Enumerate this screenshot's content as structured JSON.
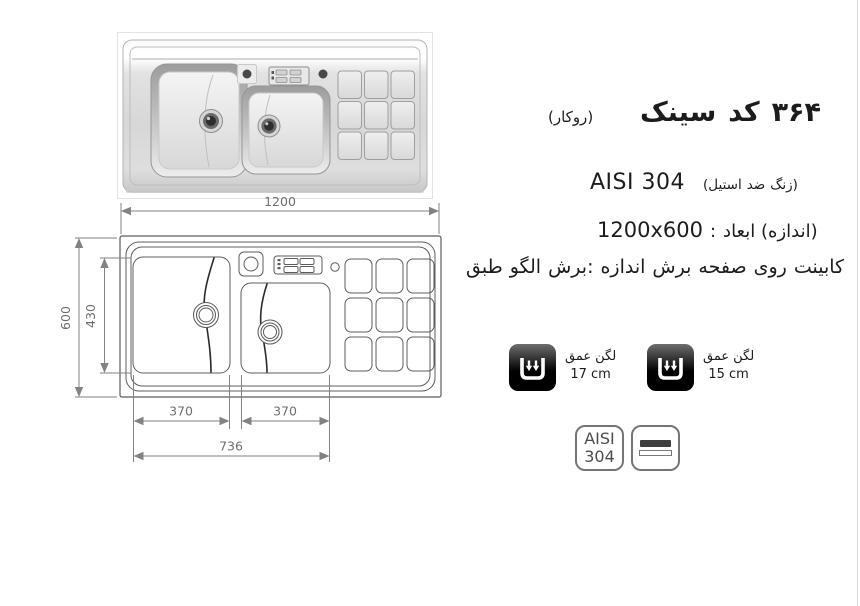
{
  "product": {
    "title_words": [
      "سینک",
      "کد",
      "۳۶۴"
    ],
    "mount_note": "(روکار)",
    "material_latin": "AISI 304",
    "material_note_words": [
      "(استیل",
      "ضد",
      "زنگ)"
    ],
    "size_value": "1200x600",
    "size_colon": ":",
    "size_label_words": [
      "ابعاد",
      "(اندازه)"
    ],
    "cut_note_words": [
      "طبق",
      "الگو",
      "برش:",
      "اندازه",
      "برش",
      "صفحه",
      "روی",
      "کابینت"
    ]
  },
  "depth_badges": [
    {
      "label_words": [
        "عمق",
        "لگن"
      ],
      "value": "17 cm"
    },
    {
      "label_words": [
        "عمق",
        "لگن"
      ],
      "value": "15 cm"
    }
  ],
  "material_badge": {
    "line1": "AISI",
    "line2": "304"
  },
  "drawing": {
    "type": "technical-top-view",
    "dims": {
      "overall_width": "1200",
      "overall_height": "600",
      "bowl_height": "430",
      "bowl1_width": "370",
      "bowl2_width": "370",
      "bowls_span": "736"
    }
  },
  "colors": {
    "text": "#1c1c1c",
    "outline": "#5c5c5c",
    "crack": "#2b2b2b",
    "dim_line": "#828282",
    "dim_text": "#6f6f6f",
    "badge_border": "#767676",
    "icon_bg": "#000000",
    "edge_line": "#dcdcdc"
  }
}
